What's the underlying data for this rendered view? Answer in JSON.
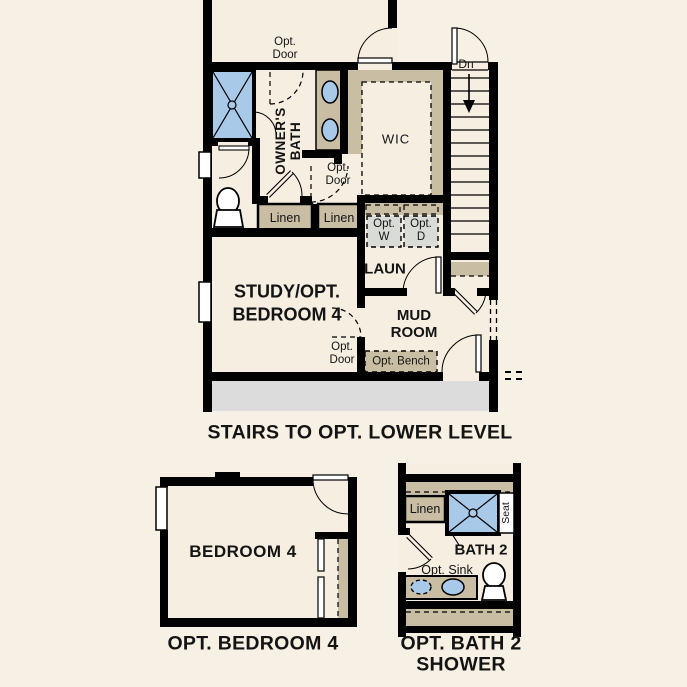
{
  "captions": {
    "main": "STAIRS TO OPT. LOWER LEVEL",
    "bedroom": "OPT. BEDROOM 4",
    "bath": "OPT. BATH 2\nSHOWER"
  },
  "main_plan": {
    "opt_door_top": "Opt.\nDoor",
    "owners_bath": "OWNER'S\nBATH",
    "wic": "WIC",
    "down": "Dn",
    "opt_door_wic": "Opt.\nDoor",
    "linen1": "Linen",
    "linen2": "Linen",
    "opt_washer": "Opt.\nW",
    "opt_dryer": "Opt.\nD",
    "laundry": "LAUN",
    "study": "STUDY/OPT.\nBEDROOM 4",
    "mud_room": "MUD\nROOM",
    "opt_door_study": "Opt.\nDoor",
    "opt_bench": "Opt. Bench"
  },
  "bedroom_plan": {
    "bedroom": "BEDROOM 4"
  },
  "bath_plan": {
    "linen": "Linen",
    "seat": "Seat",
    "bath": "BATH 2",
    "opt_sink": "Opt. Sink"
  },
  "colors": {
    "background": "#f7f0e4",
    "floor": "#f5eee1",
    "wall": "#000000",
    "cabinet_tan": "#c9bda3",
    "fixture_blue": "#a9c9e9",
    "porch_gray": "#dcdcdc",
    "appliance_gray": "#d9dbd7",
    "text": "#141414"
  }
}
